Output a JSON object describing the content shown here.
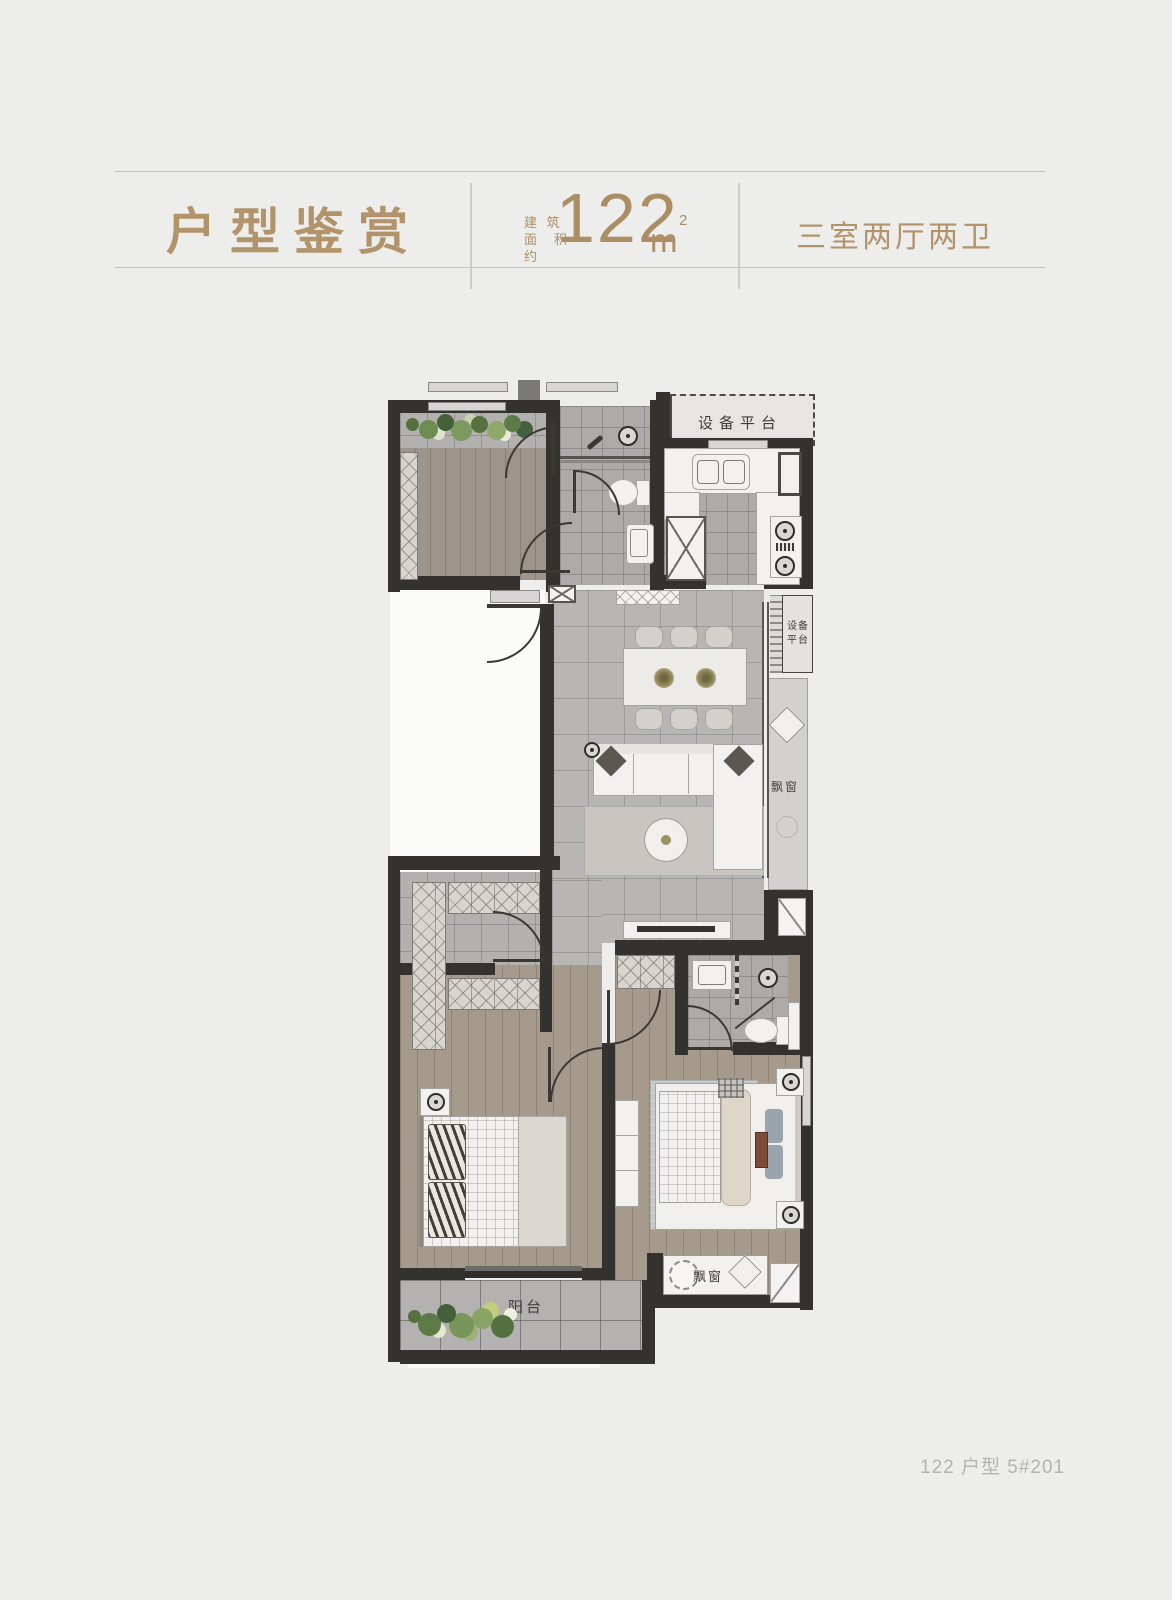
{
  "header": {
    "title": "户型鉴赏",
    "area_label_line1": "建 筑",
    "area_label_line2": "面积约",
    "area_value": "122",
    "area_unit": "m",
    "area_exponent": "2",
    "spec": "三室两厅两卫"
  },
  "plan": {
    "equipment_platform": "设备平台",
    "equipment_platform_small_l1": "设备",
    "equipment_platform_small_l2": "平台",
    "bay_window_right": "飘窗",
    "bay_window_bottom": "飘窗",
    "balcony": "阳台"
  },
  "footer": {
    "caption": "122 户型 5#201"
  },
  "colors": {
    "accent": "#b2946b",
    "wall": "#34322f",
    "page_bg": "#ededeb"
  }
}
